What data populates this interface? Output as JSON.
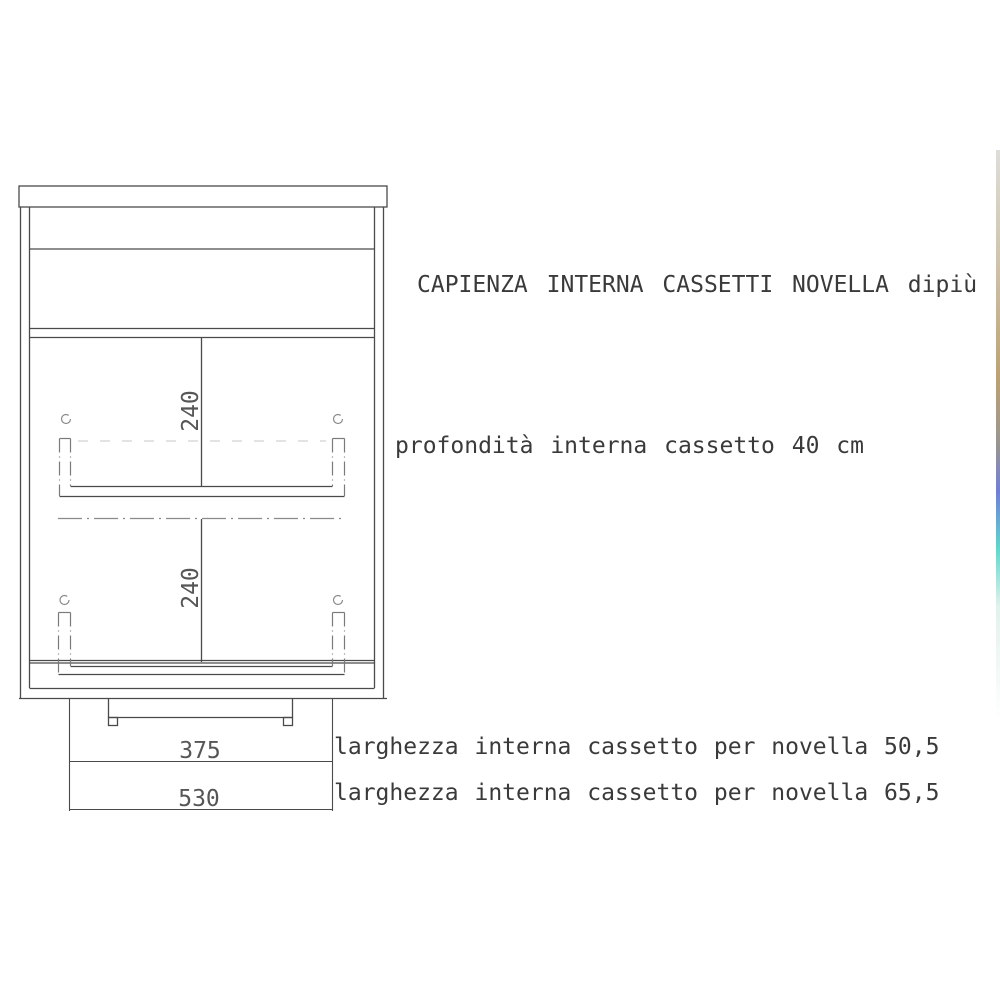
{
  "diagram": {
    "title": "CAPIENZA INTERNA CASSETTI NOVELLA dipiù",
    "annotations": {
      "depth_note": "profondità interna cassetto 40 cm",
      "width_note_1": "larghezza interna cassetto per novella 50,5",
      "width_note_2": "larghezza interna cassetto per novella 65,5"
    },
    "dimensions": {
      "upper_drawer_height": "240",
      "lower_drawer_height": "240",
      "inner_width": "375",
      "outer_width": "530"
    },
    "colors": {
      "line": "#4a4a4a",
      "light_line": "#8a8a8a",
      "faint_line": "#cfcfcf",
      "text": "#3a3a3a",
      "background": "#ffffff",
      "scan_strip_tan": "#b2905a",
      "scan_strip_blue": "#5767d2",
      "scan_strip_cyan": "#42d2c4"
    }
  }
}
